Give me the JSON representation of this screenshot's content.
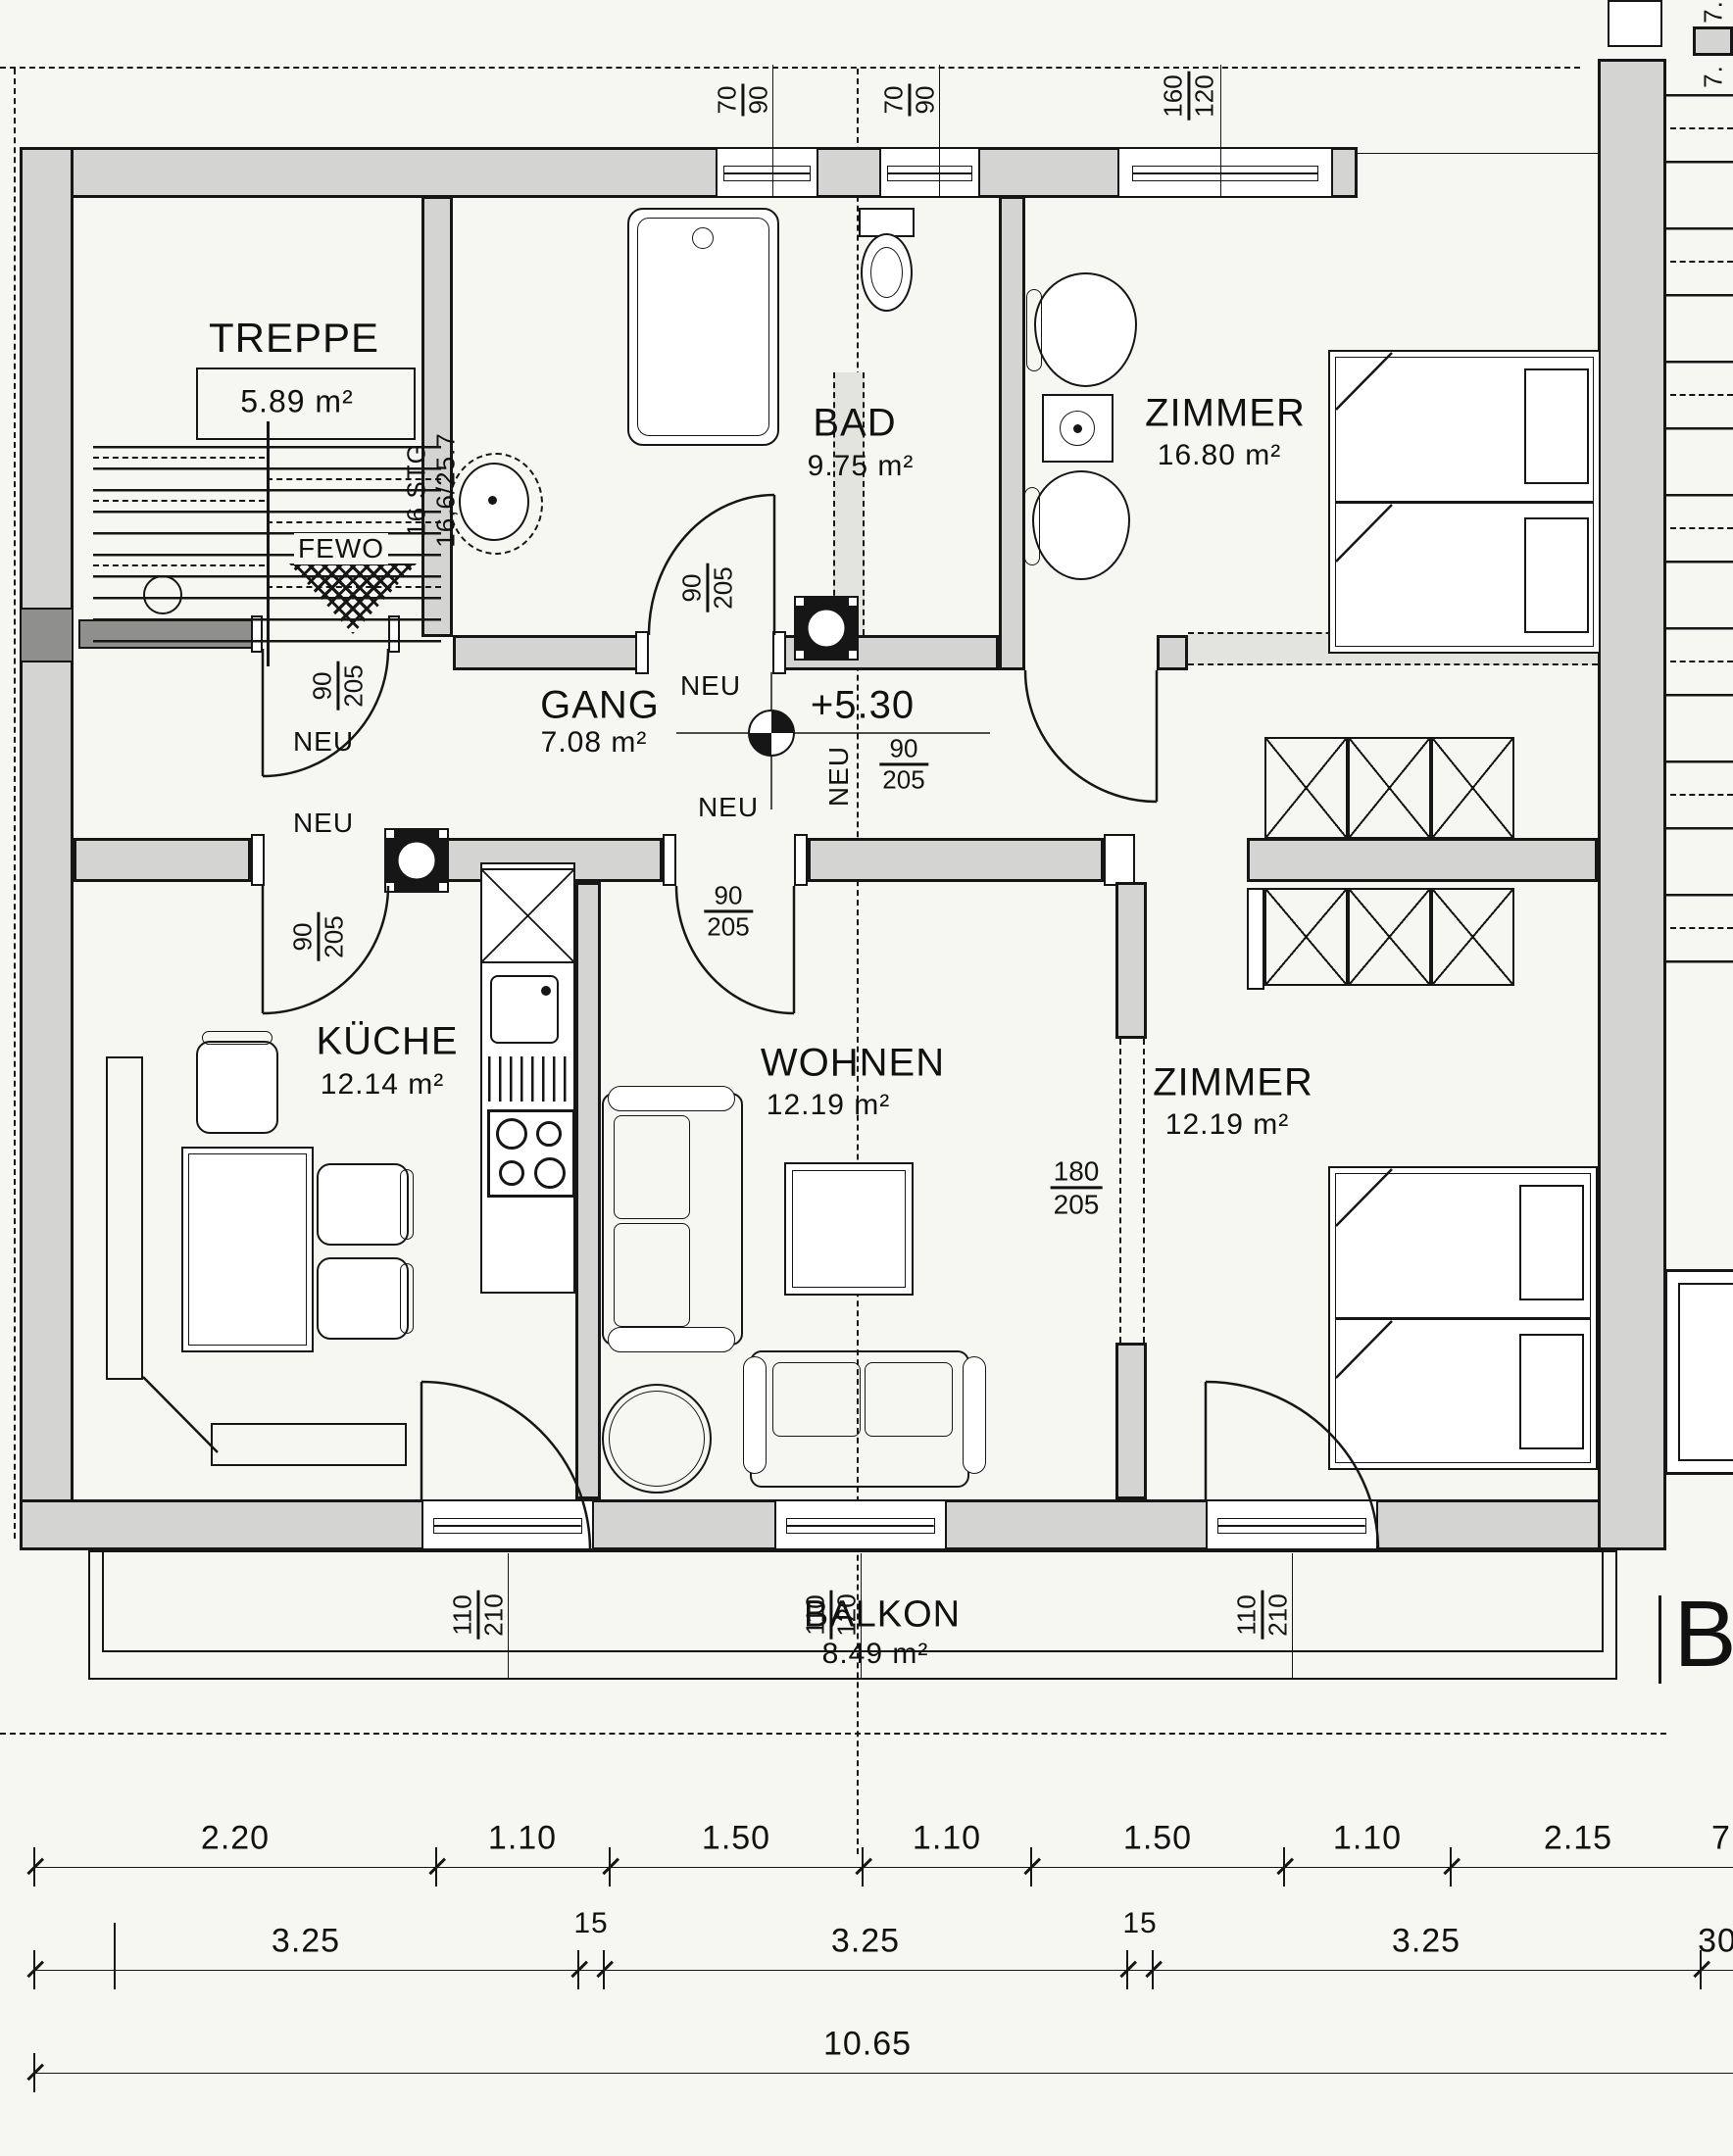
{
  "plan_title_visible": false,
  "rooms": [
    {
      "name": "TREPPE",
      "area": "5.89 m²"
    },
    {
      "name": "BAD",
      "area": "9.75 m²"
    },
    {
      "name": "ZIMMER",
      "area": "16.80 m²"
    },
    {
      "name": "GANG",
      "area": "7.08 m²"
    },
    {
      "name": "KÜCHE",
      "area": "12.14 m²"
    },
    {
      "name": "WOHNEN",
      "area": "12.19 m²"
    },
    {
      "name": "ZIMMER",
      "area": "12.19 m²"
    },
    {
      "name": "BALKON",
      "area": "8.49 m²"
    }
  ],
  "stairs": {
    "steps": "16 STG",
    "ratio": "16,6/25.7",
    "fewo": "FEWO"
  },
  "level_marker": "+5.30",
  "labels": {
    "neu": "NEU"
  },
  "fractions": {
    "door": {
      "n": "90",
      "d": "205"
    },
    "door_wide": {
      "n": "180",
      "d": "205"
    },
    "win_small": {
      "n": "70",
      "d": "90"
    },
    "win_large": {
      "n": "160",
      "d": "120"
    },
    "balcony_door": {
      "n": "110",
      "d": "210"
    },
    "balcony_win": {
      "n": "110",
      "d": "120"
    }
  },
  "section_letter": "B",
  "edge_labels": {
    "top_right_a": "7.",
    "top_right_b": "7."
  },
  "dimensions": {
    "row1": [
      "2.20",
      "1.10",
      "1.50",
      "1.10",
      "1.50",
      "1.10",
      "2.15",
      "7"
    ],
    "row2": [
      "3.25",
      "15",
      "3.25",
      "15",
      "3.25",
      "30"
    ],
    "row3": [
      "10.65"
    ]
  }
}
